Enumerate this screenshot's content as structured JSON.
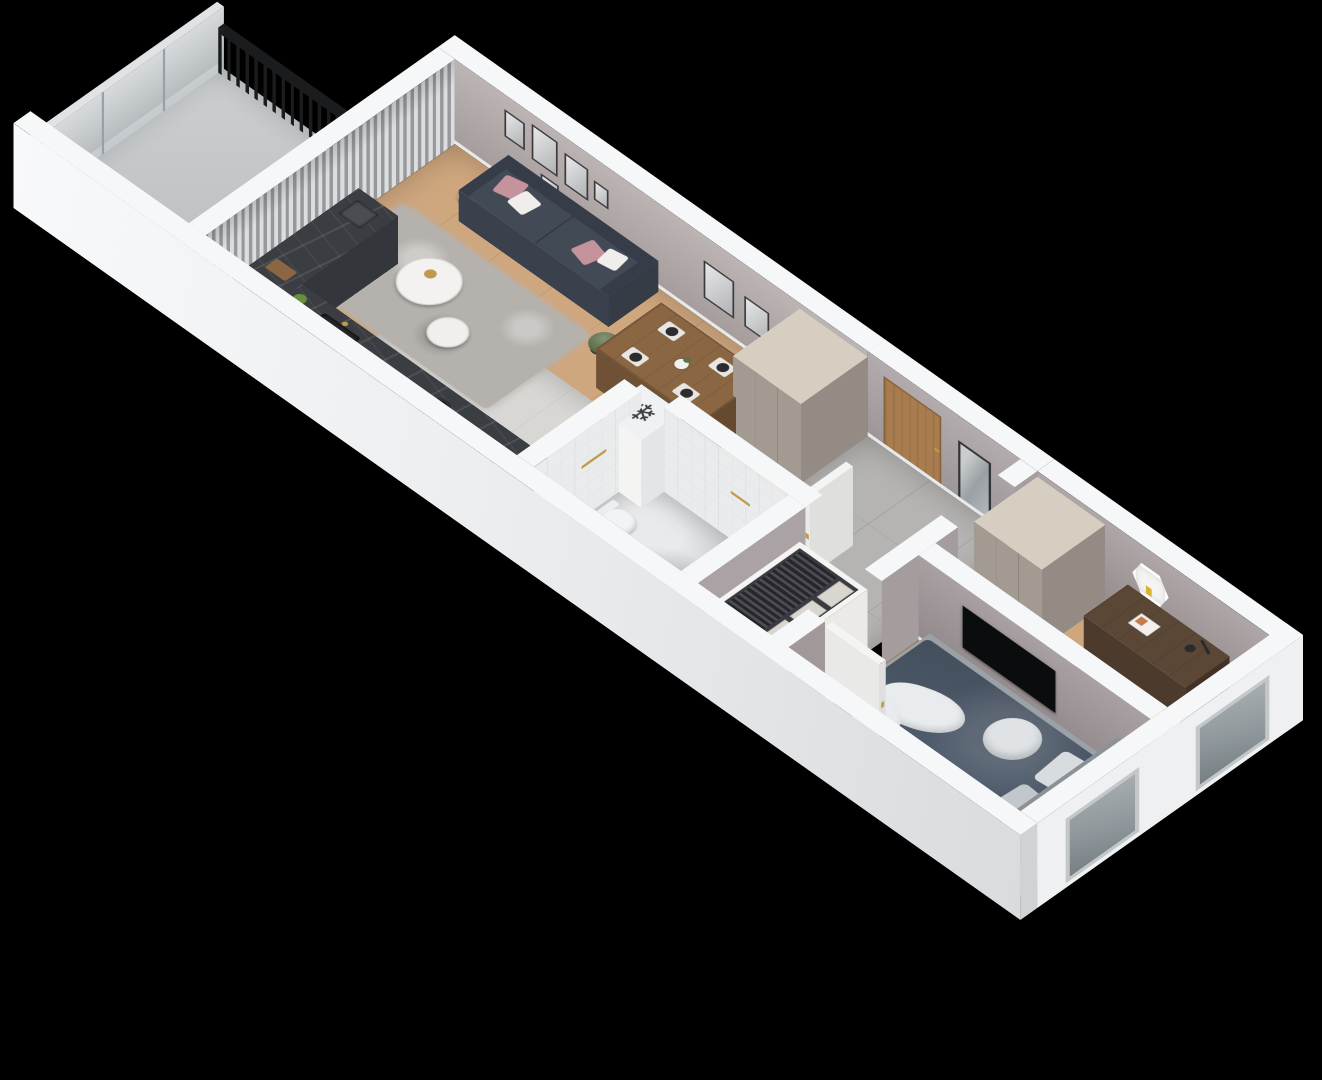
{
  "scene": {
    "title": "3D isometric floor plan of a one-bedroom apartment with balcony",
    "background": "#000000",
    "projection": "isometric",
    "visible_text": "none"
  },
  "icons": {
    "snowflake_glyph": "❄"
  },
  "palette": {
    "bg": "#000000",
    "wallTop": "#f6f7f8",
    "wallBright": "#eef0f1",
    "wallLit": "#e4e7e9",
    "wallShade": "#cfd3d6",
    "wallLiving": "#b3a9a9",
    "wallHall": "#aaa2a4",
    "wallOffice": "#a59c9d",
    "wallBedroom": "#a1989a",
    "tileWall": "#e9ebec",
    "wood": "#cfa77e",
    "woodDark": "#bb9166",
    "kitchenTile": "#d8d7d4",
    "hallTile": "#b6b4b2",
    "bathFloor": "#cfd1d4",
    "balconyFloor": "#c7c9cb",
    "counter": "#3a3d41",
    "sofa": "#424a56",
    "sofaDark": "#363d48",
    "pillowPink": "#c5939c",
    "pillowWhite": "#efeeec",
    "rug": "#b5b1ad",
    "tableWood": "#8a6643",
    "chairBeige": "#cbc4b6",
    "wardrobeFront": "#a39a92",
    "wardrobeTop": "#d7cec2",
    "wardrobeSide": "#948b84",
    "doorWood": "#a87c4f",
    "gold": "#c09a4a",
    "mirrorFrame": "#333335",
    "bedNavy": "#4e5a6a",
    "bedWhite": "#e9ecee",
    "bedBase": "#9aa1a7",
    "headboard": "#8b9196",
    "greenBed": "#6d7f5c",
    "deskWood": "#5b4736",
    "chairGray": "#716e6b",
    "rugRound": "#b7b5b2",
    "radiator": "#26282a",
    "railing": "#1b1c1e",
    "curtainLight": "#dcddde",
    "curtainDark": "#96989b",
    "tv": "#0b0c0e",
    "plant": "#5d7046",
    "plantPot": "#2e2f31",
    "white": "#f4f4f3",
    "applianceTop": "#eff1f2",
    "boxBeige": "#d9d5cf",
    "clothes": "#2b2b31",
    "glassFrost": "#ccd2d5",
    "windowGlass": "#8e979b"
  },
  "rooms": [
    {
      "name": "Balcony",
      "features": [
        "black metal railing",
        "frosted glass balustrade",
        "concrete floor"
      ]
    },
    {
      "name": "Living room with open kitchen",
      "furniture": [
        "gray curtains on balcony wall",
        "standing TV",
        "gold floor lamp with white globe",
        "dark slate sofa with pink and white cushions",
        "shaggy gray rug",
        "two round white coffee tables with gold pot",
        "potted plant",
        "gallery wall picture frames",
        "wooden dining table with four beige chairs and place settings",
        "dark marble kitchen counter with cooktop and sink",
        "tall greige wardrobe",
        "white appliance with snowflake symbol"
      ]
    },
    {
      "name": "Bathroom",
      "furniture": [
        "white tiled walls",
        "bathtub with gold fittings",
        "toilet",
        "gold towel bar",
        "marble floor"
      ]
    },
    {
      "name": "Hallway",
      "furniture": [
        "wooden entrance door with gold handle",
        "leaning black-framed mirror",
        "gray tile floor",
        "open white interior doors"
      ]
    },
    {
      "name": "Bedroom",
      "furniture": [
        "double bed with navy duvet and white throw",
        "gray upholstered base and headboard",
        "open closet with hanging clothes and storage boxes",
        "wall-mounted TV",
        "potted plant",
        "window with dark radiator"
      ]
    },
    {
      "name": "Office second bedroom",
      "furniture": [
        "greige wardrobe",
        "hexagonal white wall shelf",
        "dark wood desk with lamp and open book",
        "gray armchair",
        "round gray rug",
        "single bed with green blanket",
        "window with dark radiator"
      ]
    }
  ]
}
